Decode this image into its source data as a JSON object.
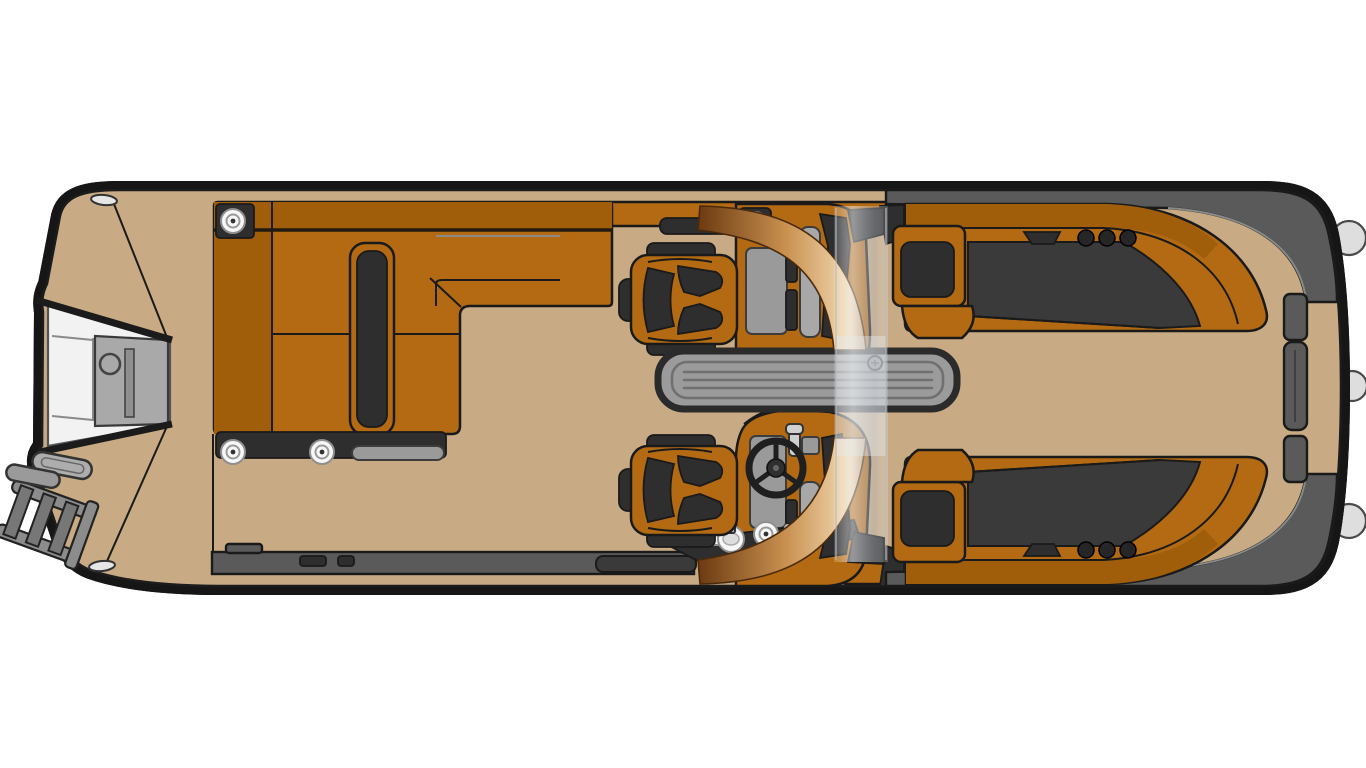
{
  "figure": {
    "type": "pontoon-boat-floorplan",
    "view": "top-down",
    "background": "#ffffff"
  },
  "colors": {
    "outline": "#1a1a1a",
    "rail_black": "#161616",
    "gunwale": "#474747",
    "deck": "#c8ab84",
    "seat": "#b36a12",
    "seat_back": "#a05e0b",
    "upholstery": "#2e2e2e",
    "upholstery2": "#3a3a3a",
    "trim": "#5a5a5a",
    "console": "#9a9a9a",
    "panel": "#a8a8a8",
    "platform": "#f2f2f2",
    "gate": "#a9a9a9",
    "table": "#9b9b9b",
    "table_line": "#707070",
    "glass": "#e9ecf1",
    "copper_dark": "#6e3c12",
    "copper_mid": "#c88f4e",
    "copper_light": "#f2d9b2",
    "copper_end": "#9c6a30",
    "fender": "#dedede",
    "speaker": "#f7f7f7",
    "metal": "#d0d0d0",
    "ladder": "#8c8c8c"
  },
  "parts": {
    "hull": "pontoon hull and deck",
    "bow_platform": "bow boarding platform",
    "bow_gate": "bow entry gate",
    "ladder": "bow boarding ladder",
    "grab_handle": "bow grab handles",
    "bow_lounge": "L-shaped bow lounge seating",
    "armrest_bolster": "lounge armrest bolster",
    "speakers": "round speakers",
    "grab_rail": "lounge grab rail",
    "captain_chair_port": "port captain chair",
    "captain_chair_starboard": "starboard helm chair",
    "glovebox_console": "port passenger console",
    "helm_console": "starboard helm console",
    "steering_wheel": "steering wheel",
    "throttle": "throttle lever",
    "drink_holder": "drink holder",
    "windshield": "walk-through windshield",
    "table": "cockpit table",
    "stern_chaise_port": "port stern chaise lounge",
    "stern_chaise_starboard": "starboard stern chaise lounge",
    "cup_holders": "cup holder trio",
    "stern_trim_port": "port stern corner trim",
    "stern_trim_starboard": "starboard stern corner trim",
    "stern_gate": "stern walk-through gate",
    "fenders": "hull fenders",
    "cleats": "mooring cleats"
  }
}
